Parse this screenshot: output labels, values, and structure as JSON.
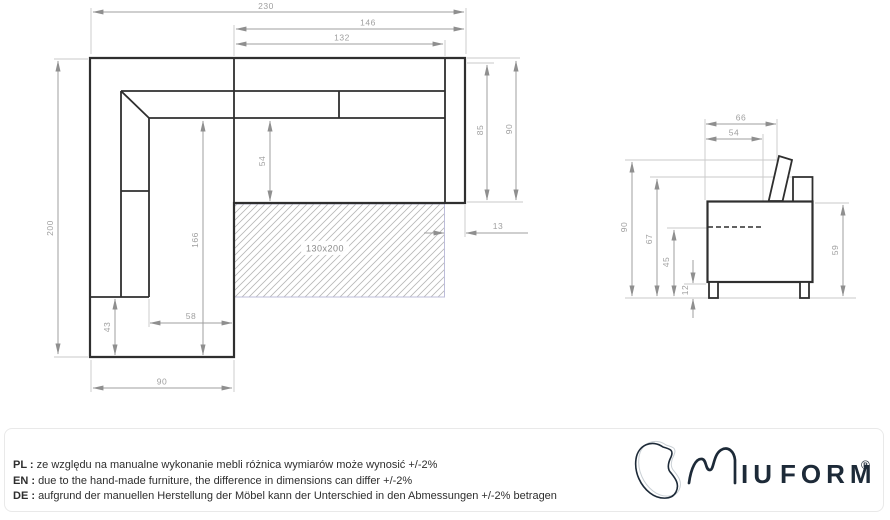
{
  "plan": {
    "d230": "230",
    "d146": "146",
    "d132": "132",
    "d200": "200",
    "d85": "85",
    "d90_right": "90",
    "d13": "13",
    "d54": "54",
    "d166": "166",
    "d43": "43",
    "d58": "58",
    "d90_bottom": "90",
    "mattress": "130x200"
  },
  "side": {
    "d66": "66",
    "d54": "54",
    "d90": "90",
    "d67": "67",
    "d45": "45",
    "d12": "12",
    "d59": "59"
  },
  "notes": [
    {
      "label": "PL",
      "sep": " : ",
      "text": "ze względu na manualne wykonanie mebli różnica wymiarów może wynosić +/-2%"
    },
    {
      "label": "EN",
      "sep": " : ",
      "text": "due to the hand-made furniture, the difference in dimensions can differ +/-2%"
    },
    {
      "label": "DE",
      "sep": " : ",
      "text": "aufgrund der manuellen Herstellung der Möbel kann der Unterschied in den Abmessungen +/-2% betragen"
    }
  ],
  "logo": {
    "iu": "IU",
    "form": "FORM",
    "reg": "®"
  },
  "colors": {
    "line": "#2f2f2f",
    "dim": "#9f9f9f",
    "hatch_border": "#bdbdda",
    "navy": "#1d2a38"
  }
}
